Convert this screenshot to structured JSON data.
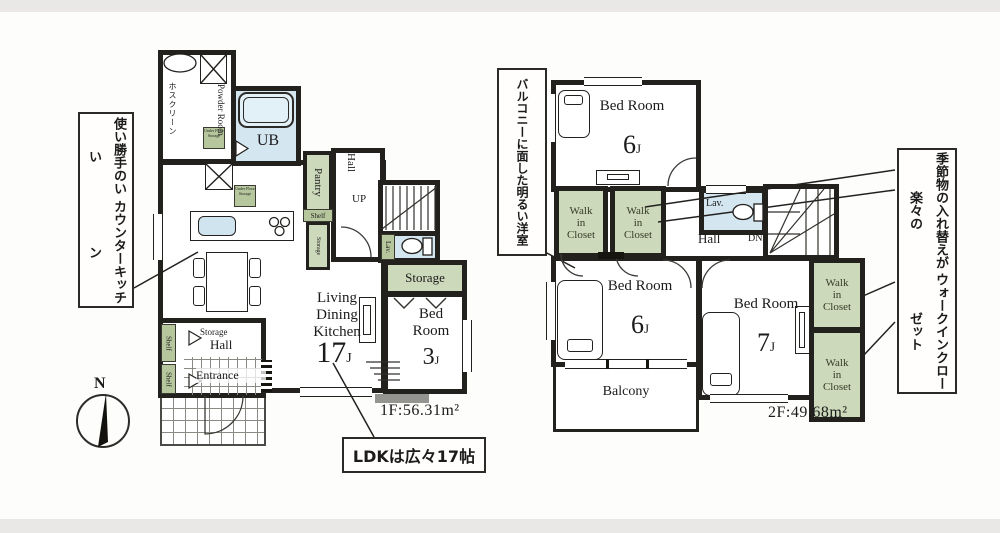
{
  "floor1": {
    "area": "1F:56.31m²",
    "compass": "N",
    "callout_kitchen_l1": "使い勝手のいい",
    "callout_kitchen_l2": "カウンターキッチン",
    "callout_ldk": "LDKは広々17帖",
    "powder_room": "Powder Room",
    "hoscreen": "ホスクリーン",
    "under_floor": "Under Floor Storage",
    "ub": "UB",
    "pantry": "Pantry",
    "shelf": "Shelf",
    "storage_vertical": "Storage",
    "hall_upper": "Hall",
    "up": "UP",
    "lav": "Lav.",
    "storage_room": "Storage",
    "bedroom3": {
      "name1": "Bed",
      "name2": "Room",
      "num": "3",
      "unit": "J"
    },
    "ldk": {
      "l1": "Living",
      "l2": "Dining",
      "l3": "Kitchen",
      "num": "17",
      "unit": "J"
    },
    "entry": {
      "storage": "Storage",
      "hall": "Hall",
      "entrance": "Entrance"
    }
  },
  "floor2": {
    "area": "2F:49.68m²",
    "callout_balcony_l1": "バルコニーに面した",
    "callout_balcony_l2": "明るい洋室",
    "callout_wic_l1": "季節物の入れ替えが楽々の",
    "callout_wic_l2": "ウォークインクローゼット",
    "wic": {
      "l1": "Walk",
      "l2": "in",
      "l3": "Closet"
    },
    "lav": "Lav.",
    "hall": "Hall",
    "dn": "DN",
    "balcony": "Balcony",
    "bedroom6a": {
      "name1": "Bed",
      "name2": "Room",
      "num": "6",
      "unit": "J"
    },
    "bedroom6b": {
      "name1": "Bed",
      "name2": "Room",
      "num": "6",
      "unit": "J"
    },
    "bedroom7": {
      "name1": "Bed",
      "name2": "Room",
      "num": "7",
      "unit": "J"
    }
  }
}
